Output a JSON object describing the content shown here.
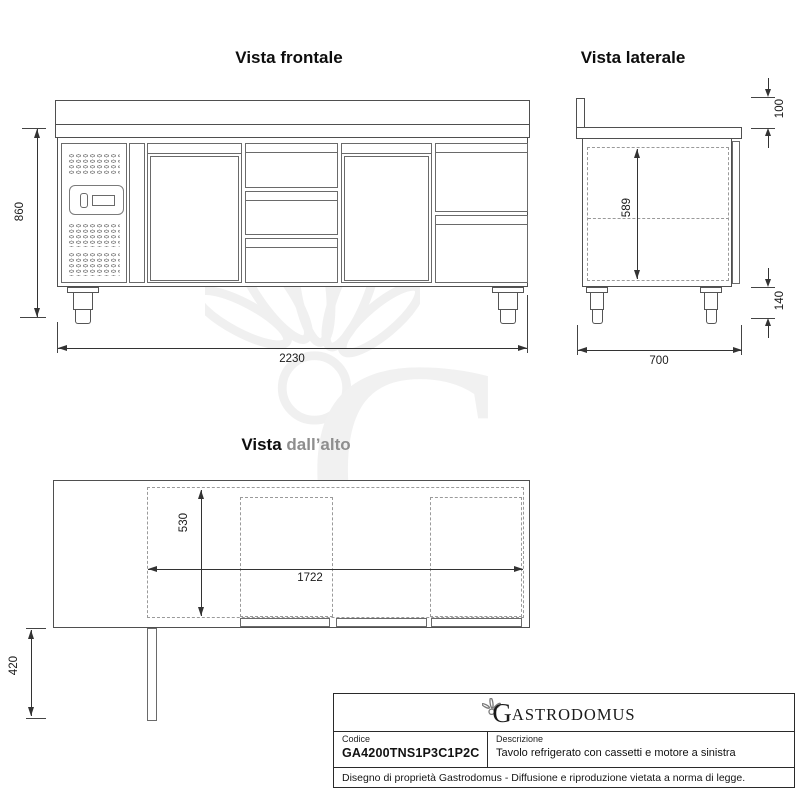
{
  "watermark": {
    "letter": "G"
  },
  "front_view": {
    "title": "Vista frontale",
    "height_dim": "860",
    "width_dim": "2230"
  },
  "side_view": {
    "title": "Vista laterale",
    "backsplash_dim": "100",
    "interior_dim": "589",
    "leg_dim": "140",
    "depth_dim": "700"
  },
  "top_view": {
    "title_prefix": "Vista",
    "title_suffix": "dall’alto",
    "depth_dim": "530",
    "width_dim": "1722",
    "door_dim": "420"
  },
  "title_block": {
    "brand_initial": "G",
    "brand_rest": "ASTRODOMUS",
    "code_label": "Codice",
    "code_value": "GA4200TNS1P3C1P2C",
    "description_label": "Descrizione",
    "description_value": "Tavolo refrigerato con cassetti e motore a sinistra",
    "disclaimer": "Disegno di proprietà Gastrodomus - Diffusione e riproduzione vietata a norma di legge."
  }
}
